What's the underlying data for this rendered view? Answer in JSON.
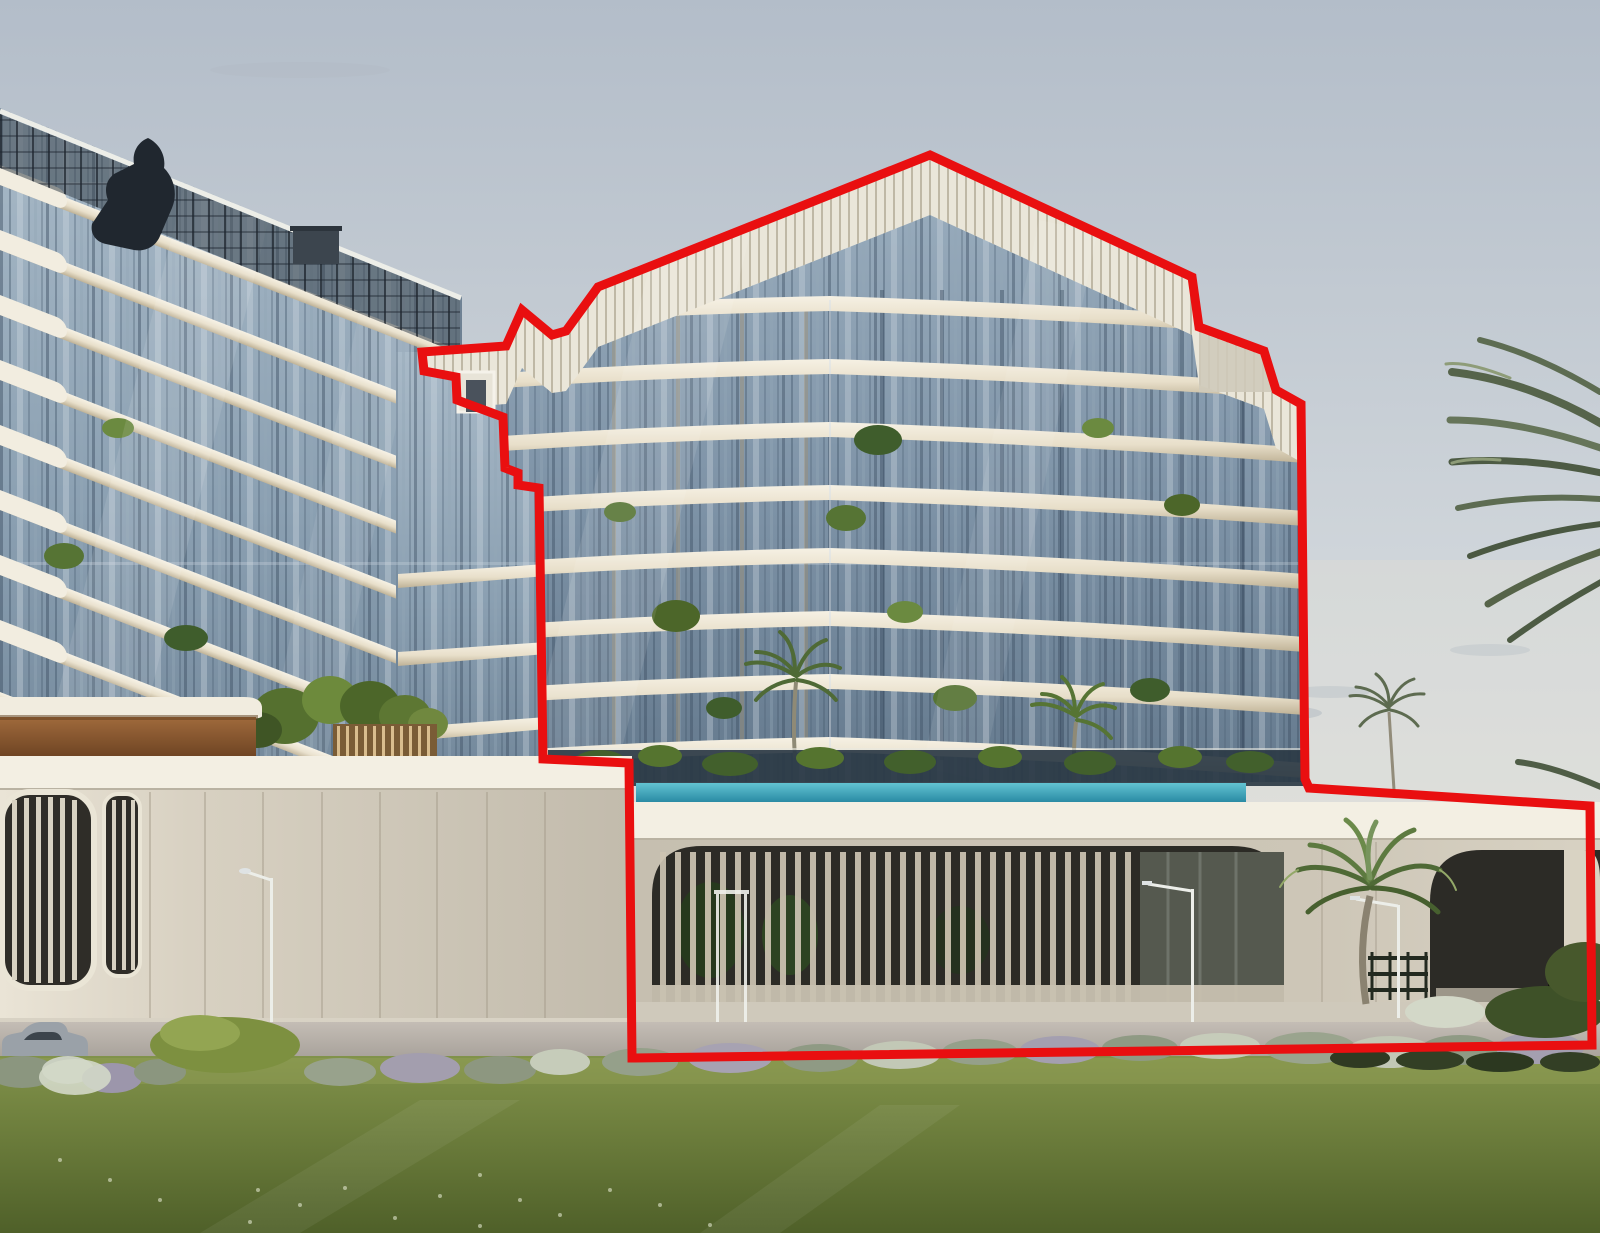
{
  "scene": {
    "title": "3D architectural rendering of a glass residential complex with lawn, podium and palm trees; one building and its podium are outlined in red",
    "elements": [
      "sky",
      "clouds",
      "left-tower",
      "connecting-wing",
      "outlined-tower",
      "louvered-crown",
      "rooftop-sculpture",
      "roof-pavilion",
      "podium",
      "pool-edge",
      "louvered-openings",
      "street-lamps",
      "palm-trees",
      "bush-row",
      "lawn",
      "car",
      "red-outline"
    ]
  },
  "annotation": {
    "label": "highlighted-building-section",
    "points": "930,155 1192,277 1199,327 1264,351 1276,390 1301,404 1305,779 1309,788 1590,806 1592,1045 632,1058 629,763 543,759 539,488 518,485 518,473 505,468 503,417 457,400 456,377 424,371 422,352 506,346 522,310 552,335 566,331 598,287",
    "color": "#e90f10",
    "stroke_width": 9
  },
  "palette": {
    "sky_top": "#b3bdc9",
    "sky_mid": "#cfd5da",
    "sky_bottom": "#ecebe6",
    "glass_light": "#a9bac8",
    "glass_mid": "#7e93a7",
    "glass_dark": "#4e6278",
    "slab_cream": "#f0e9d8",
    "slab_shadow": "#c4b79c",
    "crown_white": "#eae6d9",
    "crown_slat": "#b8b09c",
    "podium_fascia": "#f3efe3",
    "podium_face": "#cac3b4",
    "opening_dark": "#2c2b26",
    "opening_slat": "#cdc5b2",
    "wood_soffit": "#8a5a33",
    "pool_teal_light": "#62c3d2",
    "pool_teal_deep": "#1e7e9a",
    "lawn_light": "#8a9a50",
    "lawn_dark": "#55662e",
    "road_gray": "#b2aba4",
    "bush_silver": "#97a18f",
    "bush_lavender": "#a49fb2",
    "bush_white": "#cdd3c2",
    "bush_green": "#7d9040",
    "hedge_dark": "#3e5128",
    "palm_green": "#5d6e50",
    "trunk": "#8a8270",
    "lamp_white": "#eceee9",
    "sculpture_dark": "#20272f",
    "outline_red": "#e90f10"
  }
}
